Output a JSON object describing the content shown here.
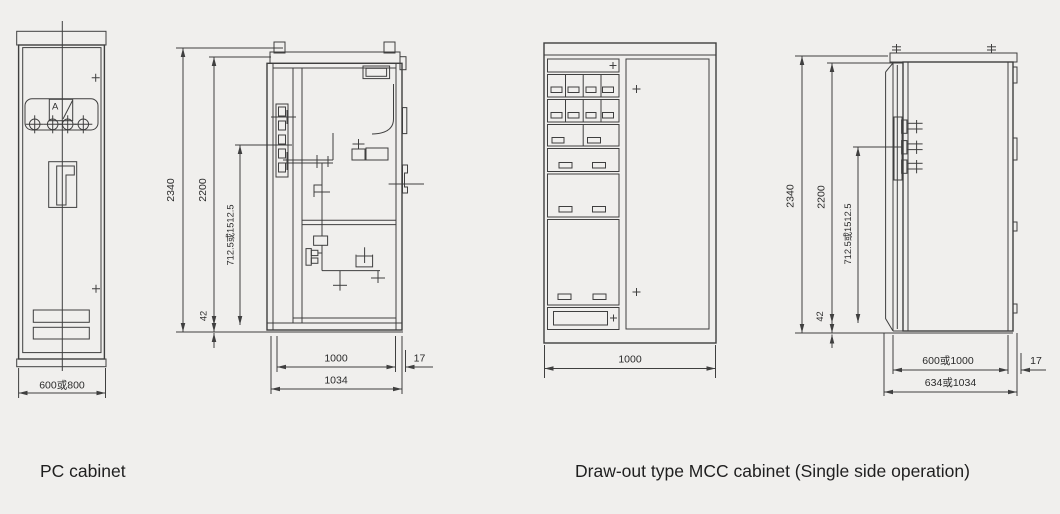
{
  "colors": {
    "background": "#f0efed",
    "line": "#3f3f3f",
    "text": "#2b2b2b"
  },
  "captions": {
    "pc": "PC cabinet",
    "mcc": "Draw-out type MCC cabinet (Single side operation)"
  },
  "pc_front": {
    "meter_label": "A",
    "dim_width": "600或800"
  },
  "pc_side": {
    "dim_total_height": "2340",
    "dim_frame_height": "2200",
    "dim_unit_height": "712.5或1512.5",
    "dim_base_height": "42",
    "dim_inner_depth": "1000",
    "dim_outer_depth": "1034",
    "dim_door": "17"
  },
  "mcc_front": {
    "dim_width": "1000"
  },
  "mcc_side": {
    "dim_total_height": "2340",
    "dim_frame_height": "2200",
    "dim_unit_height": "712.5或1512.5",
    "dim_base_height": "42",
    "dim_inner_depth": "600或1000",
    "dim_outer_depth": "634或1034",
    "dim_door": "17"
  }
}
